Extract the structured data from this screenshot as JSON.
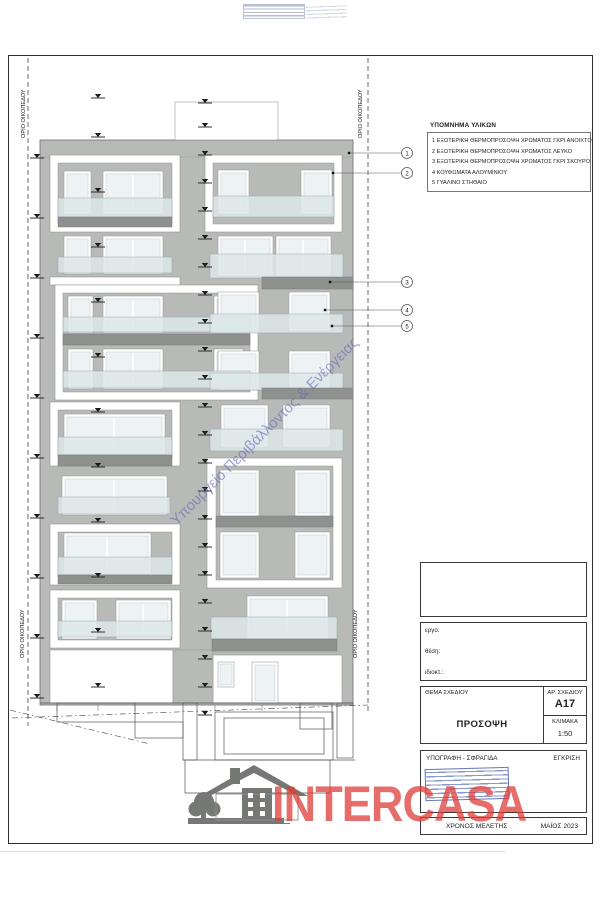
{
  "boundary": {
    "label": "ΟΡΙΟ ΟΙΚΟΠΕΔΟΥ"
  },
  "watermark": {
    "text": "Υπουργείο Περιβάλλοντος & Ενέργειας"
  },
  "legend": {
    "title": "ΥΠΟΜΝΗΜΑ ΥΛΙΚΩΝ",
    "items": [
      "1 ΕΞΩΤΕΡΙΚΗ ΘΕΡΜΟΠΡΟΣΟΨΗ ΧΡΩΜΑΤΟΣ ΓΚΡΙ ΑΝΟΙΧΤΟ",
      "2 ΕΞΩΤΕΡΙΚΗ ΘΕΡΜΟΠΡΟΣΟΨΗ ΧΡΩΜΑΤΟΣ ΛΕΥΚΟ",
      "3 ΕΞΩΤΕΡΙΚΗ ΘΕΡΜΟΠΡΟΣΟΨΗ ΧΡΩΜΑΤΟΣ ΓΚΡΙ ΣΚΟΥΡΟ",
      "4 ΚΟΥΦΩΜΑΤΑ ΑΛΟΥΜΙΝΙΟΥ",
      "5 ΓΥΑΛΙΝΟ ΣΤΗΘΑΙΟ"
    ]
  },
  "callouts": [
    "1",
    "2",
    "3",
    "4",
    "5"
  ],
  "titleblock": {
    "project_label": "εργο:",
    "location_label": "θέση:",
    "owner_label": "ιδιοκτ.:",
    "subject_label": "ΘΕΜΑ ΣΧΕΔΙΟΥ",
    "subject_value": "ΠΡΟΣΟΨΗ",
    "number_label": "ΑΡ. ΣΧΕΔΙΟΥ",
    "number_value": "A17",
    "scale_label": "ΚΛΙΜΑΚΑ",
    "scale_value": "1:50",
    "signature_label": "ΥΠΟΓΡΑΦΗ - ΣΦΡΑΓΙΔΑ",
    "approval_label": "ΕΓΚΡΙΣΗ",
    "date_label": "ΧΡΟΝΟΣ ΜΕΛΕΤΗΣ",
    "date_value": "ΜΑΪΟΣ 2023"
  },
  "logo": {
    "text": "INTERCASA"
  },
  "colors": {
    "facade_gray": "#b8bab8",
    "slab_dark": "#8f918f",
    "glass": "#dde8e9",
    "accent_red": "#dd3e38",
    "stamp_blue": "#3a55a8",
    "watermark_blue": "#6365bc"
  }
}
